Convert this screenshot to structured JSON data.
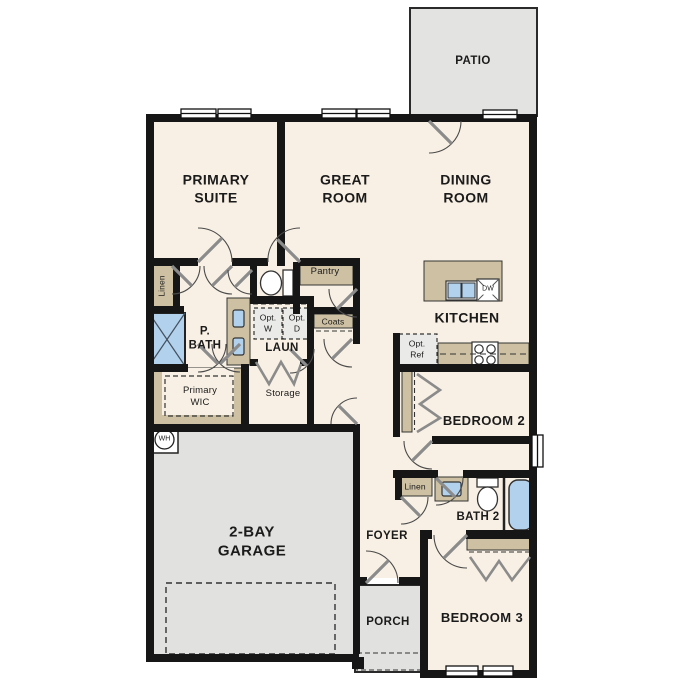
{
  "plan": {
    "title": "Single-story 3-bedroom floor plan",
    "rooms": {
      "patio": "PATIO",
      "primary_suite": "PRIMARY\nSUITE",
      "great_room": "GREAT\nROOM",
      "dining_room": "DINING\nROOM",
      "kitchen": "KITCHEN",
      "p_bath": "P.\nBATH",
      "laundry": "LAUN",
      "storage": "Storage",
      "primary_wic": "Primary\nWIC",
      "pantry": "Pantry",
      "coats": "Coats",
      "linen_primary": "Linen",
      "linen_hall": "Linen",
      "bedroom2": "BEDROOM 2",
      "bath2": "BATH 2",
      "bedroom3": "BEDROOM 3",
      "foyer": "FOYER",
      "porch": "PORCH",
      "garage": "2-BAY\nGARAGE"
    },
    "appliances": {
      "opt_washer": "Opt.\nW",
      "opt_dryer": "Opt.\nD",
      "opt_ref": "Opt.\nRef",
      "dishwasher": "DW",
      "water_heater": "WH"
    },
    "colors": {
      "floor": "#f8f0e4",
      "exterior_concrete": "#e3e4e2",
      "garage_concrete": "#e1e1df",
      "wall": "#161616",
      "casework_tan": "#cdc0a3",
      "fixture_blue": "#b2d1ec",
      "optional_fill": "#eaeae8"
    }
  }
}
